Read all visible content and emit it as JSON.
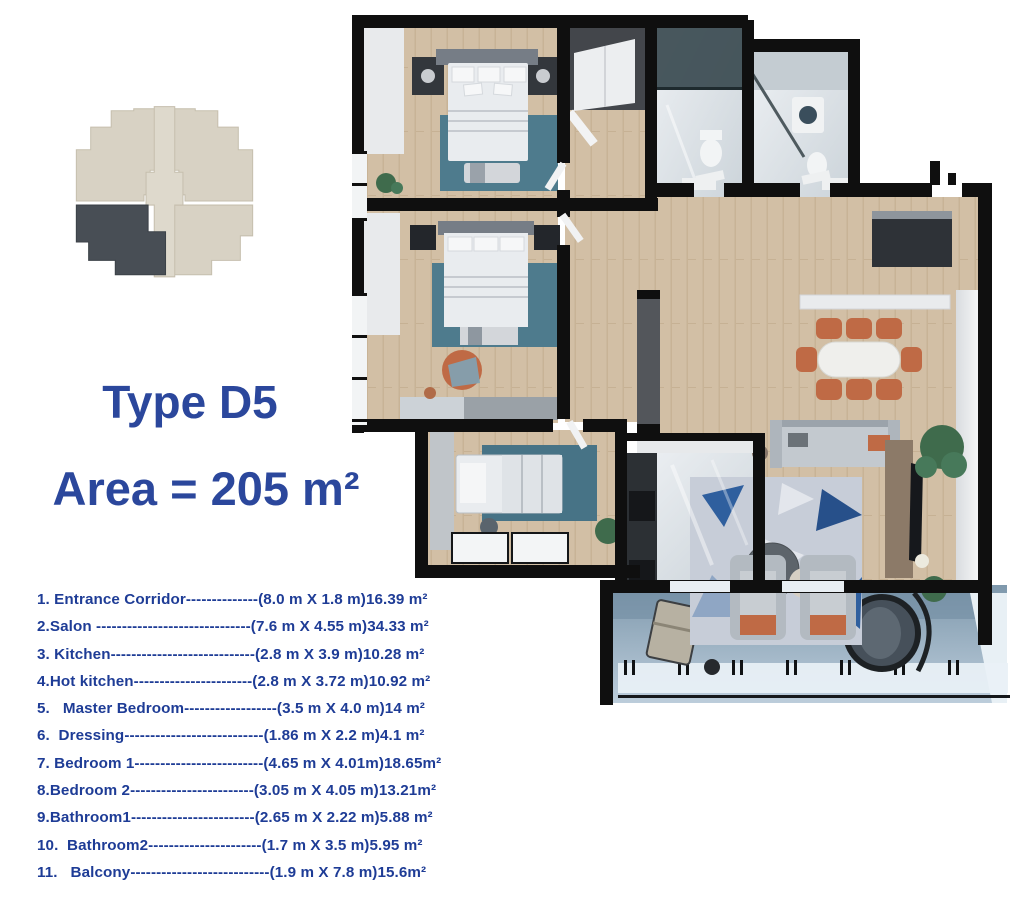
{
  "header": {
    "type_label": "Type D5",
    "area_label": "Area = 205 m²"
  },
  "key_plan": {
    "highlighted_unit": "bottom-left-quadrant"
  },
  "room_list": [
    {
      "name": "1. Entrance Corridor",
      "leader": "--------------",
      "size": "(8.0 m X 1.8 m)",
      "area": "16.39 m²"
    },
    {
      "name": "2.Salon ",
      "leader": "------------------------------",
      "size": "(7.6 m X 4.55 m)",
      "area": "34.33 m²"
    },
    {
      "name": "3. Kitchen",
      "leader": "----------------------------",
      "size": "(2.8 m X 3.9 m)",
      "area": "10.28 m²"
    },
    {
      "name": "4.Hot kitchen",
      "leader": "-----------------------",
      "size": "(2.8 m X 3.72 m)",
      "area": "10.92 m²"
    },
    {
      "name": "5.   Master Bedroom",
      "leader": "------------------",
      "size": "(3.5 m X 4.0 m)",
      "area": "14 m²"
    },
    {
      "name": "6.  Dressing",
      "leader": "---------------------------",
      "size": "(1.86 m X 2.2 m)",
      "area": "4.1 m²"
    },
    {
      "name": "7. Bedroom 1",
      "leader": "-------------------------",
      "size": "(4.65 m X 4.01m)",
      "area": "18.65m²"
    },
    {
      "name": "8.Bedroom 2",
      "leader": "------------------------",
      "size": "(3.05 m X 4.05 m)",
      "area": "13.21m²"
    },
    {
      "name": "9.Bathroom1",
      "leader": "------------------------",
      "size": "(2.65 m X 2.22 m)",
      "area": "5.88 m²"
    },
    {
      "name": "10.  Bathroom2",
      "leader": "----------------------",
      "size": "(1.7 m X 3.5 m)",
      "area": "5.95 m²"
    },
    {
      "name": "11.   Balcony",
      "leader": "---------------------------",
      "size": "(1.9 m X 7.8 m)",
      "area": "15.6m²"
    }
  ],
  "colors": {
    "title_blue": "#2b479c",
    "list_blue": "#1e3c96",
    "wall_black": "#0f0f0f",
    "wood_floor": "#d2bfa5",
    "marble_light": "#eef1f4",
    "marble_dark": "#ccd4da",
    "rug_teal": "#4e7b8d",
    "salon_rug": "#c7cdd8",
    "salon_rug_triangle": "#2f5f9e",
    "accent_orange": "#bf6a45",
    "balcony_floor": "#7e98ac",
    "plant_green": "#3f6b4c",
    "keyplan_beige": "#d8d2c4",
    "keyplan_dark": "#484e55"
  }
}
